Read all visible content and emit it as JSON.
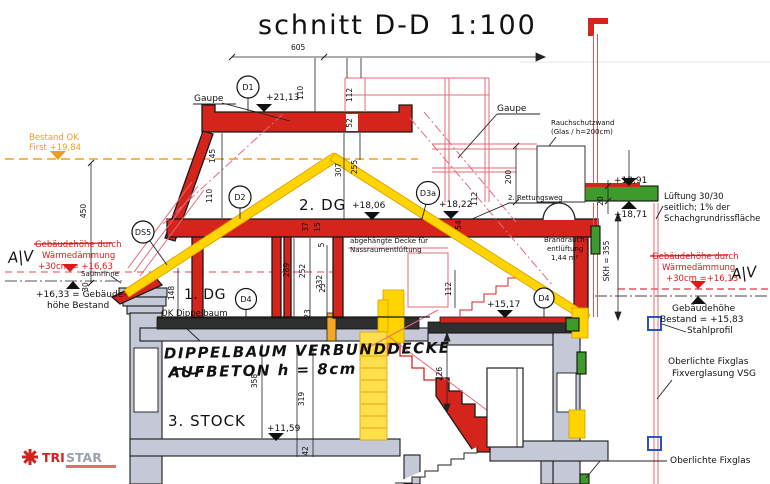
{
  "title": {
    "text": "schnitt D-D",
    "scale": "1:100"
  },
  "logo": {
    "tri": "TRI",
    "star": "STAR"
  },
  "rooms": {
    "dg2": "2. DG",
    "dg1": "1. DG",
    "stock3": "3. STOCK"
  },
  "labels": {
    "gaupe_left": "Gaupe",
    "gaupe_right": "Gaupe",
    "rauchschutzwand": [
      "Rauchschutzwand",
      "(Glas / h=200cm)"
    ],
    "rettungsweg": "2. Rettungsweg",
    "abgehaengte_decke": [
      "abgehängte Decke für",
      "Nassraumentlüftung"
    ],
    "brandrauch": [
      "Brandrauch-",
      "entlüftung",
      "1,44 m²"
    ],
    "ok_dippelbaum": "OK Dippelbaum",
    "saumrinne": "Saumrinne",
    "lueftung": [
      "Lüftung 30/30",
      "seitlich; 1% der",
      "Schachgrundrissfläche"
    ],
    "oberlichte_1": [
      "Oberlichte Fixglas",
      "Fixverglasung VSG"
    ],
    "oberlichte_2": "Oberlichte Fixglas",
    "stahlprofil": "Stahlprofil"
  },
  "levels": {
    "first_bestand": [
      "Bestand OK",
      "First +19,84"
    ],
    "daemmung_left": [
      "Gebäudehöhe durch",
      "Wärmedämmung",
      "+30cm = +16,63"
    ],
    "bestand_left": [
      "+16,33 = Gebäude-",
      "höhe Bestand"
    ],
    "daemmung_right": [
      "Gebäudehöhe durch",
      "Wärmedämmung",
      "+30cm =+16,13"
    ],
    "bestand_right": [
      "Gebäudehöhe",
      "Bestand = +15,83"
    ],
    "e2113": "+21,13",
    "e1806": "+18,06",
    "e1822": "+18,22",
    "e1891": "+18,91",
    "e1871": "+18,71",
    "e1517": "+15,17",
    "e1159": "+11,59"
  },
  "handwritten": {
    "deck_note_1": "DIPPELBAUM VERBUNDDECKE",
    "deck_note_2": "AUFBETON h = 8cm",
    "rev_mark_left": "A|Ⅴ",
    "rev_mark_right": "A|Ⅴ"
  },
  "detail_markers": {
    "d1": "D1",
    "d2": "D2",
    "d3a": "D3a",
    "d4_left": "D4",
    "d4_right": "D4",
    "ds5": "DS5"
  },
  "dimensions": {
    "w605": "605",
    "h110_top": "110",
    "h112_top": "112",
    "h52": "52",
    "h145": "145",
    "h307": "307",
    "h255": "255",
    "h110_d2": "110",
    "h112_gaupe": "112",
    "h450": "450",
    "h30": "30",
    "h148": "148",
    "h289": "289",
    "h252": "252",
    "h232": "232",
    "h37": "37",
    "h15": "15",
    "h5": "5",
    "h200": "200",
    "h20": "20",
    "skh": "SKH = 355",
    "h54": "54",
    "h112_stair": "112",
    "h226": "226",
    "h23_a": "23",
    "h23_b": "23",
    "h358": "358",
    "h319": "319",
    "h42": "42"
  },
  "colors": {
    "red": "#d5241c",
    "yellow": "#ffd400",
    "green": "#3f9a2d",
    "gray_wall": "#c5c9d7",
    "orange": "#f09d1e",
    "pink": "#e8697a",
    "blue_marker": "#2b51c9",
    "red_text": "#e01818"
  }
}
